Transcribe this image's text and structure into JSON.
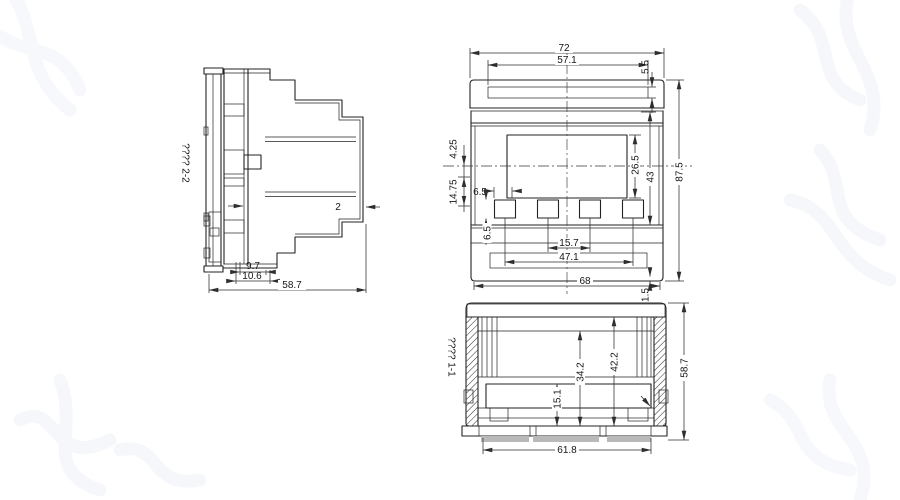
{
  "drawing": {
    "side_section": {
      "label": "???? 2-2",
      "dims": {
        "wall_thickness": "2",
        "slab_depth": "9.7",
        "clip_depth": "10.6",
        "total_depth": "58.7"
      }
    },
    "front_view": {
      "dims": {
        "overall_width": "72",
        "top_recess_width": "57.1",
        "top_recess_height": "5.5",
        "display_height": "26.5",
        "face_height": "43",
        "overall_height": "87.5",
        "offset_a": "4.25",
        "offset_b": "14.75",
        "button_width": "6.5",
        "button_height": "6.5",
        "button_pitch": "15.7",
        "button_span": "47.1",
        "base_width": "68",
        "base_lip": "1.5"
      }
    },
    "bottom_section": {
      "label": "???? 1-1",
      "dims": {
        "cavity_depth_a": "42.2",
        "cavity_depth_b": "34.2",
        "cavity_depth_c": "15.1",
        "total_depth": "58.7",
        "inner_width": "61.8"
      }
    },
    "watermark": {
      "color": "#eef2f8"
    }
  }
}
